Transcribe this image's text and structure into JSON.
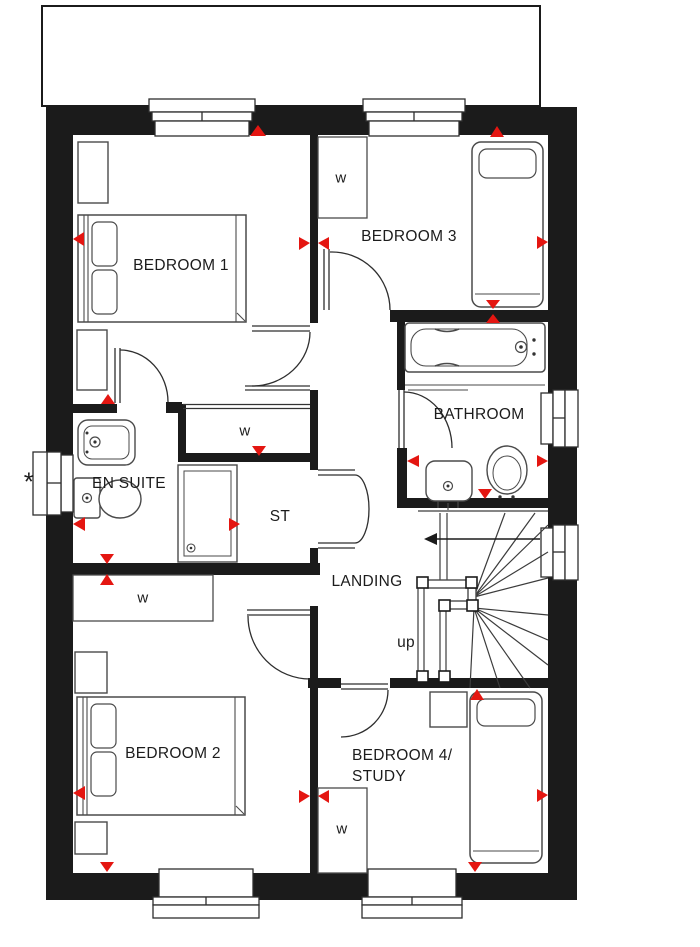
{
  "plan": {
    "rooms": {
      "bedroom1": {
        "label": "BEDROOM 1"
      },
      "bedroom2": {
        "label": "BEDROOM 2"
      },
      "bedroom3": {
        "label": "BEDROOM 3"
      },
      "bedroom4_study": {
        "label_line1": "BEDROOM 4/",
        "label_line2": "STUDY"
      },
      "bathroom": {
        "label": "BATHROOM"
      },
      "en_suite": {
        "label": "EN SUITE"
      },
      "landing": {
        "label": "LANDING"
      },
      "store": {
        "label": "ST"
      }
    },
    "stairs": {
      "direction_label": "up"
    },
    "wardrobe_label": "w",
    "window_note": "*",
    "colors": {
      "wall_black": "#1b1b1b",
      "marker_red": "#e41611",
      "furniture_line": "#4a4a4a"
    }
  }
}
